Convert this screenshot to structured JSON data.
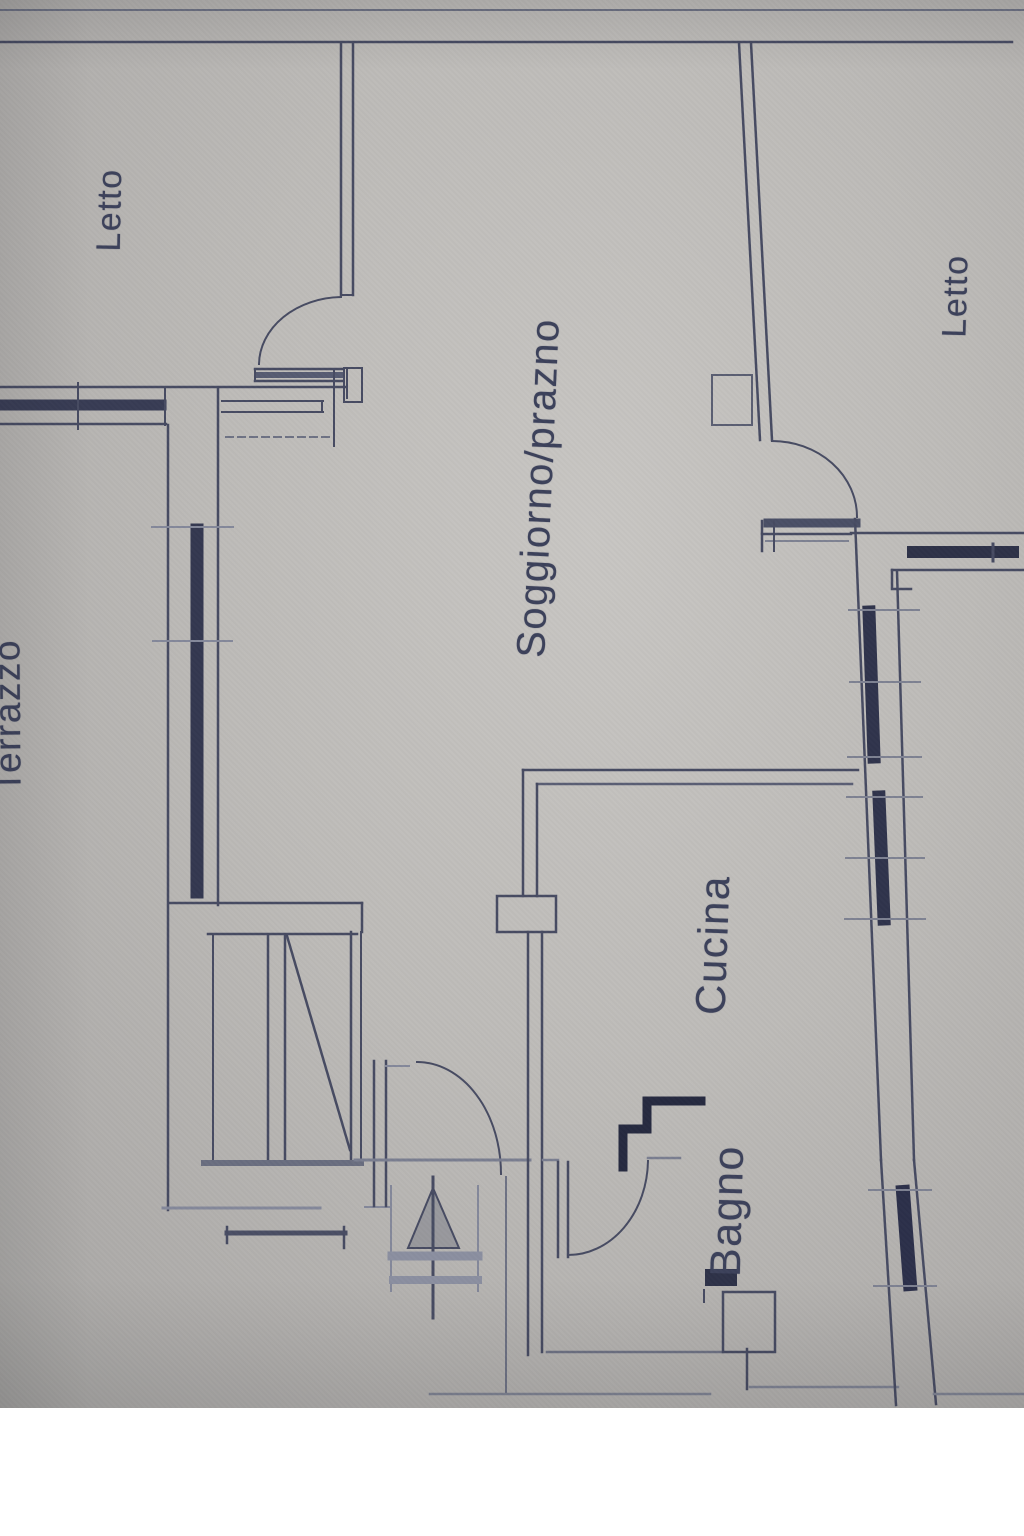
{
  "scene": {
    "description": "Photograph of a hand-drafted apartment floor plan on grey paper; labels written in Italian, rotated 90 degrees",
    "bottom_margin": "white"
  },
  "colors": {
    "ink": "#474b62",
    "ink_faded": "#84889a",
    "ink_dark": "#2e3248",
    "paper": "#bcbab7",
    "label_ink": "#3c415a",
    "margin": "#ffffff"
  },
  "rooms": [
    {
      "id": "letto-upper-left",
      "label": "Letto"
    },
    {
      "id": "terrazzo",
      "label": "Terrazzo"
    },
    {
      "id": "soggiorno-pranzo",
      "label": "Soggiorno/prazno"
    },
    {
      "id": "cucina",
      "label": "Cucina"
    },
    {
      "id": "bagno",
      "label": "Bagno"
    },
    {
      "id": "letto-right",
      "label": "Letto"
    }
  ]
}
